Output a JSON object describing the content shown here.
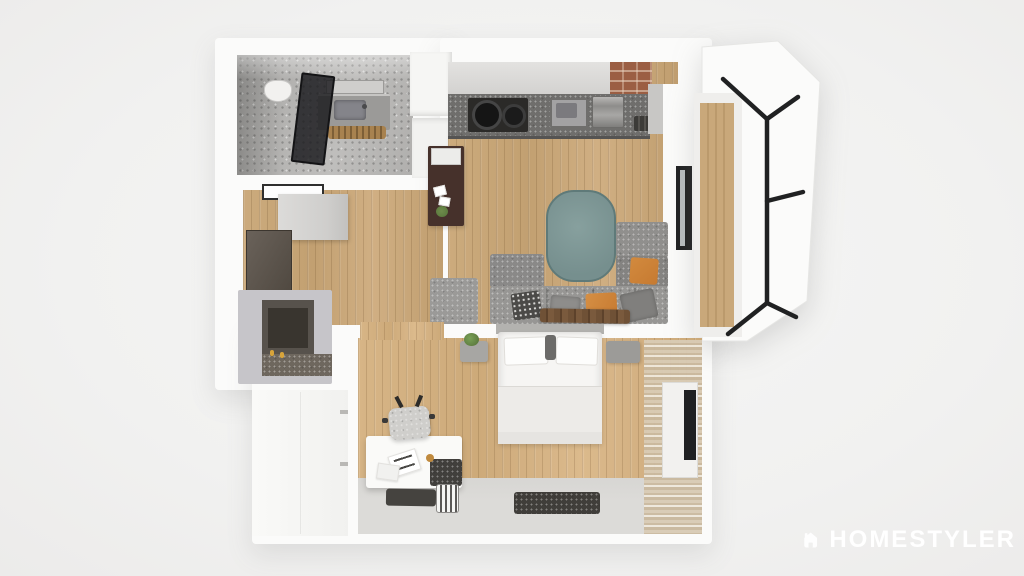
{
  "watermark": {
    "brand": "HOMESTYLER"
  },
  "palette": {
    "bg": "#f1f1f0",
    "bg_light": "#f6f6f5",
    "wall": "#fbfbfa",
    "wood": "#c8a778",
    "concrete": "#b4b3b1",
    "counter": "#6f6e6c",
    "cabinet_gray": "#d9d8d6",
    "sofa": "#92918f",
    "sofa_dark": "#848381",
    "teal": "#7e9997",
    "teal_edge": "#5f7a79",
    "orange": "#c67a31",
    "shelf_brown": "#46312b",
    "bench_brown": "#6f5136",
    "rug_dark": "#403e3a",
    "gray_floor": "#dcdbd8",
    "curtain": "#cdbda6",
    "frame_black": "#202122",
    "glass_dark": "#232327",
    "brick": "#9b5e43",
    "plant_green": "#5d7b3f",
    "white_furn": "#f8f8f6"
  },
  "scene": {
    "title": "apartment-floor-plan-3d-top-view",
    "rooms": [
      {
        "name": "bathroom",
        "furniture": [
          "toilet",
          "vanity-sink",
          "mirror",
          "shower-glass-panel",
          "wood-bath-mat"
        ]
      },
      {
        "name": "entry-hall",
        "furniture": [
          "ceiling-light-panel",
          "wardrobe-cabinet",
          "tall-dark-cabinet",
          "fireplace-counter"
        ]
      },
      {
        "name": "living-room",
        "furniture": [
          "kitchen-counter",
          "stove-pots",
          "kitchen-sink",
          "appliance",
          "range-vent",
          "brick-column",
          "console-shelf",
          "plant",
          "teal-mat",
          "sectional-sofa",
          "orange-pillows",
          "patterned-pillow",
          "wood-bench",
          "window"
        ]
      },
      {
        "name": "balcony",
        "furniture": [
          "glazing-frames",
          "wood-deck"
        ]
      },
      {
        "name": "bedroom",
        "furniture": [
          "double-bed",
          "pillows",
          "nightstand-left",
          "nightstand-right",
          "plant",
          "desk",
          "desk-chair",
          "papers",
          "dark-box",
          "book-shelf",
          "books",
          "dark-rug",
          "curtains",
          "window",
          "wardrobe-closet"
        ]
      }
    ]
  }
}
